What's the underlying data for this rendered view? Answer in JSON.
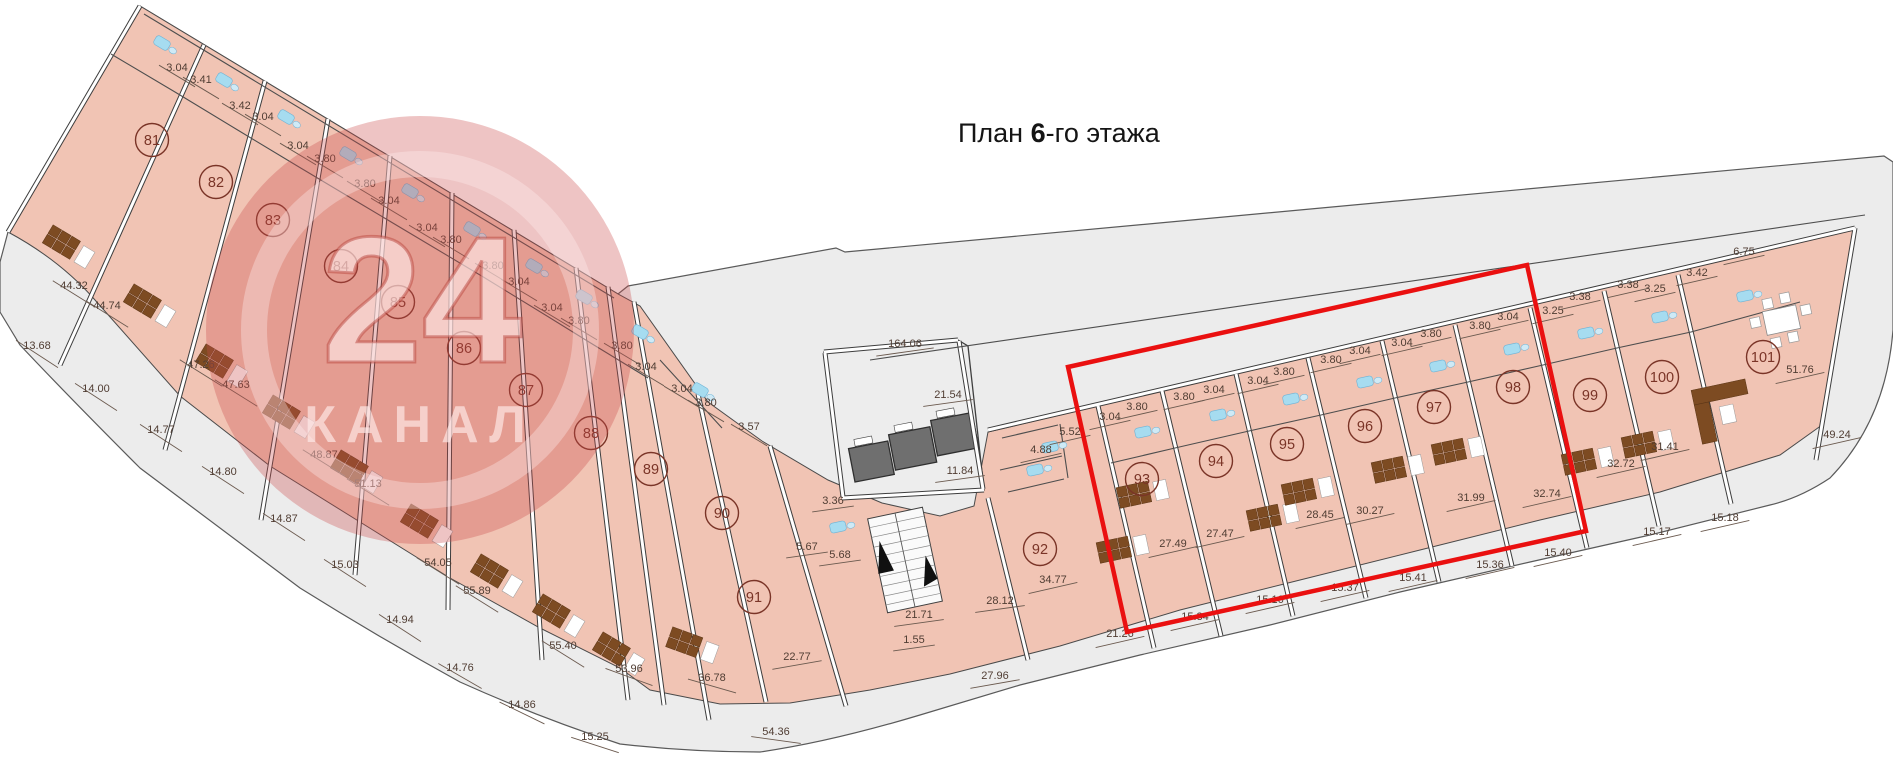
{
  "title": {
    "prefix": "План ",
    "bold": "6",
    "suffix": "-го этажа"
  },
  "watermark": {
    "number": "24",
    "name": "КАНАЛ"
  },
  "colors": {
    "room_fill": "#f1c4b4",
    "terrace_fill": "#ececec",
    "wall_dark": "#3d3d3d",
    "wall_white": "#ffffff",
    "dim_text": "#503d33",
    "dim_line": "#6b5a4f",
    "unit_mark": "#7a3427",
    "elevator_fill": "#6f6f6f",
    "fixture_blue": "#a6dcf0",
    "furniture_brown": "#7d4b22",
    "highlight_red": "#ea1010",
    "watermark_red": "rgba(203,75,75,0.33)"
  },
  "plan": {
    "units": [
      {
        "id": "81",
        "x": 152,
        "y": 140
      },
      {
        "id": "82",
        "x": 216,
        "y": 182
      },
      {
        "id": "83",
        "x": 273,
        "y": 220
      },
      {
        "id": "84",
        "x": 341,
        "y": 266
      },
      {
        "id": "85",
        "x": 398,
        "y": 302
      },
      {
        "id": "86",
        "x": 464,
        "y": 348
      },
      {
        "id": "87",
        "x": 526,
        "y": 390
      },
      {
        "id": "88",
        "x": 591,
        "y": 433
      },
      {
        "id": "89",
        "x": 651,
        "y": 469
      },
      {
        "id": "90",
        "x": 722,
        "y": 513
      },
      {
        "id": "91",
        "x": 754,
        "y": 597
      },
      {
        "id": "92",
        "x": 1040,
        "y": 549
      },
      {
        "id": "93",
        "x": 1142,
        "y": 479
      },
      {
        "id": "94",
        "x": 1216,
        "y": 461
      },
      {
        "id": "95",
        "x": 1287,
        "y": 444
      },
      {
        "id": "96",
        "x": 1365,
        "y": 426
      },
      {
        "id": "97",
        "x": 1434,
        "y": 407
      },
      {
        "id": "98",
        "x": 1513,
        "y": 387
      },
      {
        "id": "99",
        "x": 1590,
        "y": 395
      },
      {
        "id": "100",
        "x": 1662,
        "y": 377
      },
      {
        "id": "101",
        "x": 1763,
        "y": 357
      }
    ],
    "dimensions": [
      {
        "v": "3.04",
        "x": 177,
        "y": 68,
        "a": 31
      },
      {
        "v": "3.41",
        "x": 201,
        "y": 80,
        "a": 31
      },
      {
        "v": "3.42",
        "x": 240,
        "y": 106,
        "a": 31
      },
      {
        "v": "3.04",
        "x": 263,
        "y": 117,
        "a": 31
      },
      {
        "v": "3.04",
        "x": 298,
        "y": 146,
        "a": 31
      },
      {
        "v": "3.80",
        "x": 325,
        "y": 159,
        "a": 31
      },
      {
        "v": "3.80",
        "x": 365,
        "y": 184,
        "a": 31
      },
      {
        "v": "3.04",
        "x": 389,
        "y": 201,
        "a": 31
      },
      {
        "v": "3.04",
        "x": 427,
        "y": 228,
        "a": 31
      },
      {
        "v": "3.80",
        "x": 451,
        "y": 240,
        "a": 31
      },
      {
        "v": "3.80",
        "x": 493,
        "y": 266,
        "a": 31
      },
      {
        "v": "3.04",
        "x": 519,
        "y": 282,
        "a": 31
      },
      {
        "v": "3.04",
        "x": 552,
        "y": 308,
        "a": 31
      },
      {
        "v": "3.80",
        "x": 579,
        "y": 321,
        "a": 31
      },
      {
        "v": "3.80",
        "x": 622,
        "y": 346,
        "a": 31
      },
      {
        "v": "3.04",
        "x": 646,
        "y": 367,
        "a": 31
      },
      {
        "v": "3.04",
        "x": 682,
        "y": 389,
        "a": 31
      },
      {
        "v": "3.80",
        "x": 706,
        "y": 403,
        "a": 31
      },
      {
        "v": "3.57",
        "x": 749,
        "y": 427,
        "a": 31
      },
      {
        "v": "44.32",
        "x": 74,
        "y": 286,
        "a": 32
      },
      {
        "v": "44.74",
        "x": 107,
        "y": 306,
        "a": 32
      },
      {
        "v": "47.26",
        "x": 201,
        "y": 365,
        "a": 32
      },
      {
        "v": "47.63",
        "x": 236,
        "y": 385,
        "a": 32
      },
      {
        "v": "48.87",
        "x": 324,
        "y": 455,
        "a": 32
      },
      {
        "v": "51.13",
        "x": 368,
        "y": 484,
        "a": 32
      },
      {
        "v": "54.05",
        "x": 438,
        "y": 563,
        "a": 32
      },
      {
        "v": "55.89",
        "x": 477,
        "y": 591,
        "a": 32
      },
      {
        "v": "55.40",
        "x": 563,
        "y": 646,
        "a": 32
      },
      {
        "v": "53.96",
        "x": 629,
        "y": 669,
        "a": 20
      },
      {
        "v": "36.78",
        "x": 712,
        "y": 678,
        "a": 16
      },
      {
        "v": "22.77",
        "x": 797,
        "y": 657,
        "a": -10
      },
      {
        "v": "13.68",
        "x": 37,
        "y": 346,
        "a": 33
      },
      {
        "v": "14.00",
        "x": 96,
        "y": 389,
        "a": 33
      },
      {
        "v": "14.77",
        "x": 161,
        "y": 430,
        "a": 33
      },
      {
        "v": "14.80",
        "x": 223,
        "y": 472,
        "a": 33
      },
      {
        "v": "14.87",
        "x": 284,
        "y": 519,
        "a": 33
      },
      {
        "v": "15.03",
        "x": 345,
        "y": 565,
        "a": 33
      },
      {
        "v": "14.94",
        "x": 400,
        "y": 620,
        "a": 33
      },
      {
        "v": "14.76",
        "x": 460,
        "y": 668,
        "a": 30
      },
      {
        "v": "14.86",
        "x": 522,
        "y": 705,
        "a": 26
      },
      {
        "v": "15.25",
        "x": 595,
        "y": 737,
        "a": 18
      },
      {
        "v": "54.36",
        "x": 776,
        "y": 732,
        "a": 8
      },
      {
        "v": "164.06",
        "x": 905,
        "y": 344,
        "a": -8
      },
      {
        "v": "21.54",
        "x": 948,
        "y": 395,
        "a": -8
      },
      {
        "v": "11.84",
        "x": 960,
        "y": 471,
        "a": -8
      },
      {
        "v": "3.36",
        "x": 833,
        "y": 501,
        "a": -8
      },
      {
        "v": "5.67",
        "x": 807,
        "y": 547,
        "a": -8
      },
      {
        "v": "5.68",
        "x": 840,
        "y": 555,
        "a": -8
      },
      {
        "v": "21.71",
        "x": 919,
        "y": 615,
        "a": -8
      },
      {
        "v": "1.55",
        "x": 914,
        "y": 640,
        "a": -8
      },
      {
        "v": "28.12",
        "x": 1000,
        "y": 601,
        "a": -8
      },
      {
        "v": "27.96",
        "x": 995,
        "y": 676,
        "a": -10
      },
      {
        "v": "21.26",
        "x": 1120,
        "y": 634,
        "a": -13
      },
      {
        "v": "5.52",
        "x": 1070,
        "y": 432,
        "a": -13
      },
      {
        "v": "4.88",
        "x": 1041,
        "y": 450,
        "a": -13
      },
      {
        "v": "34.77",
        "x": 1053,
        "y": 580,
        "a": -13
      },
      {
        "v": "3.04",
        "x": 1110,
        "y": 417,
        "a": -13
      },
      {
        "v": "3.80",
        "x": 1137,
        "y": 407,
        "a": -13
      },
      {
        "v": "3.80",
        "x": 1184,
        "y": 397,
        "a": -13
      },
      {
        "v": "3.04",
        "x": 1214,
        "y": 390,
        "a": -13
      },
      {
        "v": "3.04",
        "x": 1258,
        "y": 381,
        "a": -13
      },
      {
        "v": "3.80",
        "x": 1284,
        "y": 372,
        "a": -13
      },
      {
        "v": "3.80",
        "x": 1331,
        "y": 360,
        "a": -13
      },
      {
        "v": "3.04",
        "x": 1360,
        "y": 351,
        "a": -13
      },
      {
        "v": "3.04",
        "x": 1402,
        "y": 343,
        "a": -13
      },
      {
        "v": "3.80",
        "x": 1431,
        "y": 334,
        "a": -13
      },
      {
        "v": "3.80",
        "x": 1480,
        "y": 326,
        "a": -13
      },
      {
        "v": "3.04",
        "x": 1508,
        "y": 317,
        "a": -13
      },
      {
        "v": "3.25",
        "x": 1553,
        "y": 311,
        "a": -13
      },
      {
        "v": "3.38",
        "x": 1580,
        "y": 297,
        "a": -13
      },
      {
        "v": "3.38",
        "x": 1628,
        "y": 285,
        "a": -13
      },
      {
        "v": "3.25",
        "x": 1655,
        "y": 289,
        "a": -13
      },
      {
        "v": "3.42",
        "x": 1697,
        "y": 273,
        "a": -13
      },
      {
        "v": "6.75",
        "x": 1744,
        "y": 252,
        "a": -13
      },
      {
        "v": "27.49",
        "x": 1173,
        "y": 544,
        "a": -13
      },
      {
        "v": "27.47",
        "x": 1220,
        "y": 534,
        "a": -13
      },
      {
        "v": "28.45",
        "x": 1320,
        "y": 515,
        "a": -13
      },
      {
        "v": "30.27",
        "x": 1370,
        "y": 511,
        "a": -13
      },
      {
        "v": "31.99",
        "x": 1471,
        "y": 498,
        "a": -13
      },
      {
        "v": "32.74",
        "x": 1547,
        "y": 494,
        "a": -13
      },
      {
        "v": "32.72",
        "x": 1621,
        "y": 464,
        "a": -13
      },
      {
        "v": "31.41",
        "x": 1665,
        "y": 447,
        "a": -13
      },
      {
        "v": "51.76",
        "x": 1800,
        "y": 370,
        "a": -13
      },
      {
        "v": "49.24",
        "x": 1837,
        "y": 435,
        "a": -13
      },
      {
        "v": "15.34",
        "x": 1195,
        "y": 617,
        "a": -13
      },
      {
        "v": "15.16",
        "x": 1270,
        "y": 600,
        "a": -13
      },
      {
        "v": "15.37",
        "x": 1345,
        "y": 588,
        "a": -13
      },
      {
        "v": "15.41",
        "x": 1413,
        "y": 578,
        "a": -13
      },
      {
        "v": "15.36",
        "x": 1490,
        "y": 565,
        "a": -13
      },
      {
        "v": "15.40",
        "x": 1558,
        "y": 553,
        "a": -13
      },
      {
        "v": "15.17",
        "x": 1657,
        "y": 532,
        "a": -13
      },
      {
        "v": "15.18",
        "x": 1725,
        "y": 518,
        "a": -13
      }
    ],
    "highlight": {
      "points": "1068,367 1527,265 1586,531 1127,632",
      "color": "#ea1010"
    }
  }
}
